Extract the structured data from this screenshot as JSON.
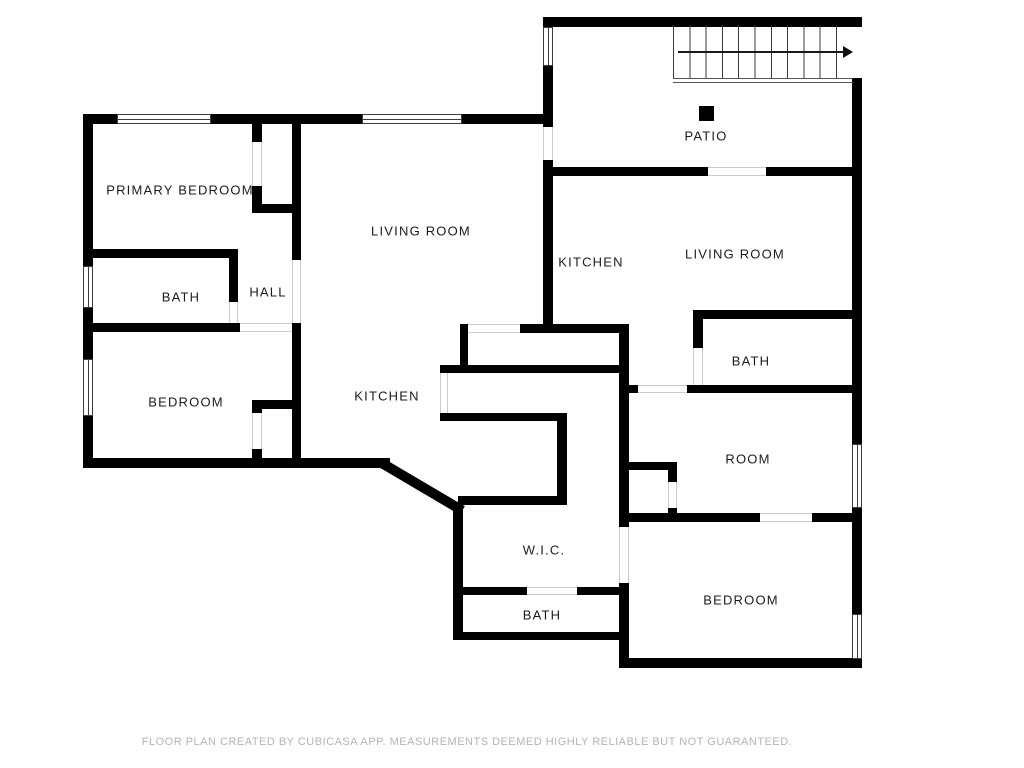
{
  "plan": {
    "rooms": [
      {
        "id": "primary-bedroom",
        "label": "PRIMARY BEDROOM"
      },
      {
        "id": "living-room-left",
        "label": "LIVING ROOM"
      },
      {
        "id": "bath-left",
        "label": "BATH"
      },
      {
        "id": "hall",
        "label": "HALL"
      },
      {
        "id": "bedroom-left",
        "label": "BEDROOM"
      },
      {
        "id": "kitchen-left",
        "label": "KITCHEN"
      },
      {
        "id": "patio",
        "label": "PATIO"
      },
      {
        "id": "kitchen-right",
        "label": "KITCHEN"
      },
      {
        "id": "living-room-right",
        "label": "LIVING ROOM"
      },
      {
        "id": "bath-right",
        "label": "BATH"
      },
      {
        "id": "room",
        "label": "ROOM"
      },
      {
        "id": "bedroom-right",
        "label": "BEDROOM"
      },
      {
        "id": "wic",
        "label": "W.I.C."
      },
      {
        "id": "bath-bottom",
        "label": "BATH"
      }
    ],
    "stairs": {
      "treads": 11,
      "direction_arrow": "right"
    },
    "footer": "FLOOR PLAN CREATED BY CUBICASA APP. MEASUREMENTS DEEMED HIGHLY RELIABLE BUT NOT GUARANTEED.",
    "colors": {
      "wall": "#000000",
      "label": "#1c1c1c",
      "footer": "#b4b4b4",
      "door-line": "#cccccc",
      "window-frame": "#3c3c3c",
      "background": "#ffffff"
    }
  }
}
